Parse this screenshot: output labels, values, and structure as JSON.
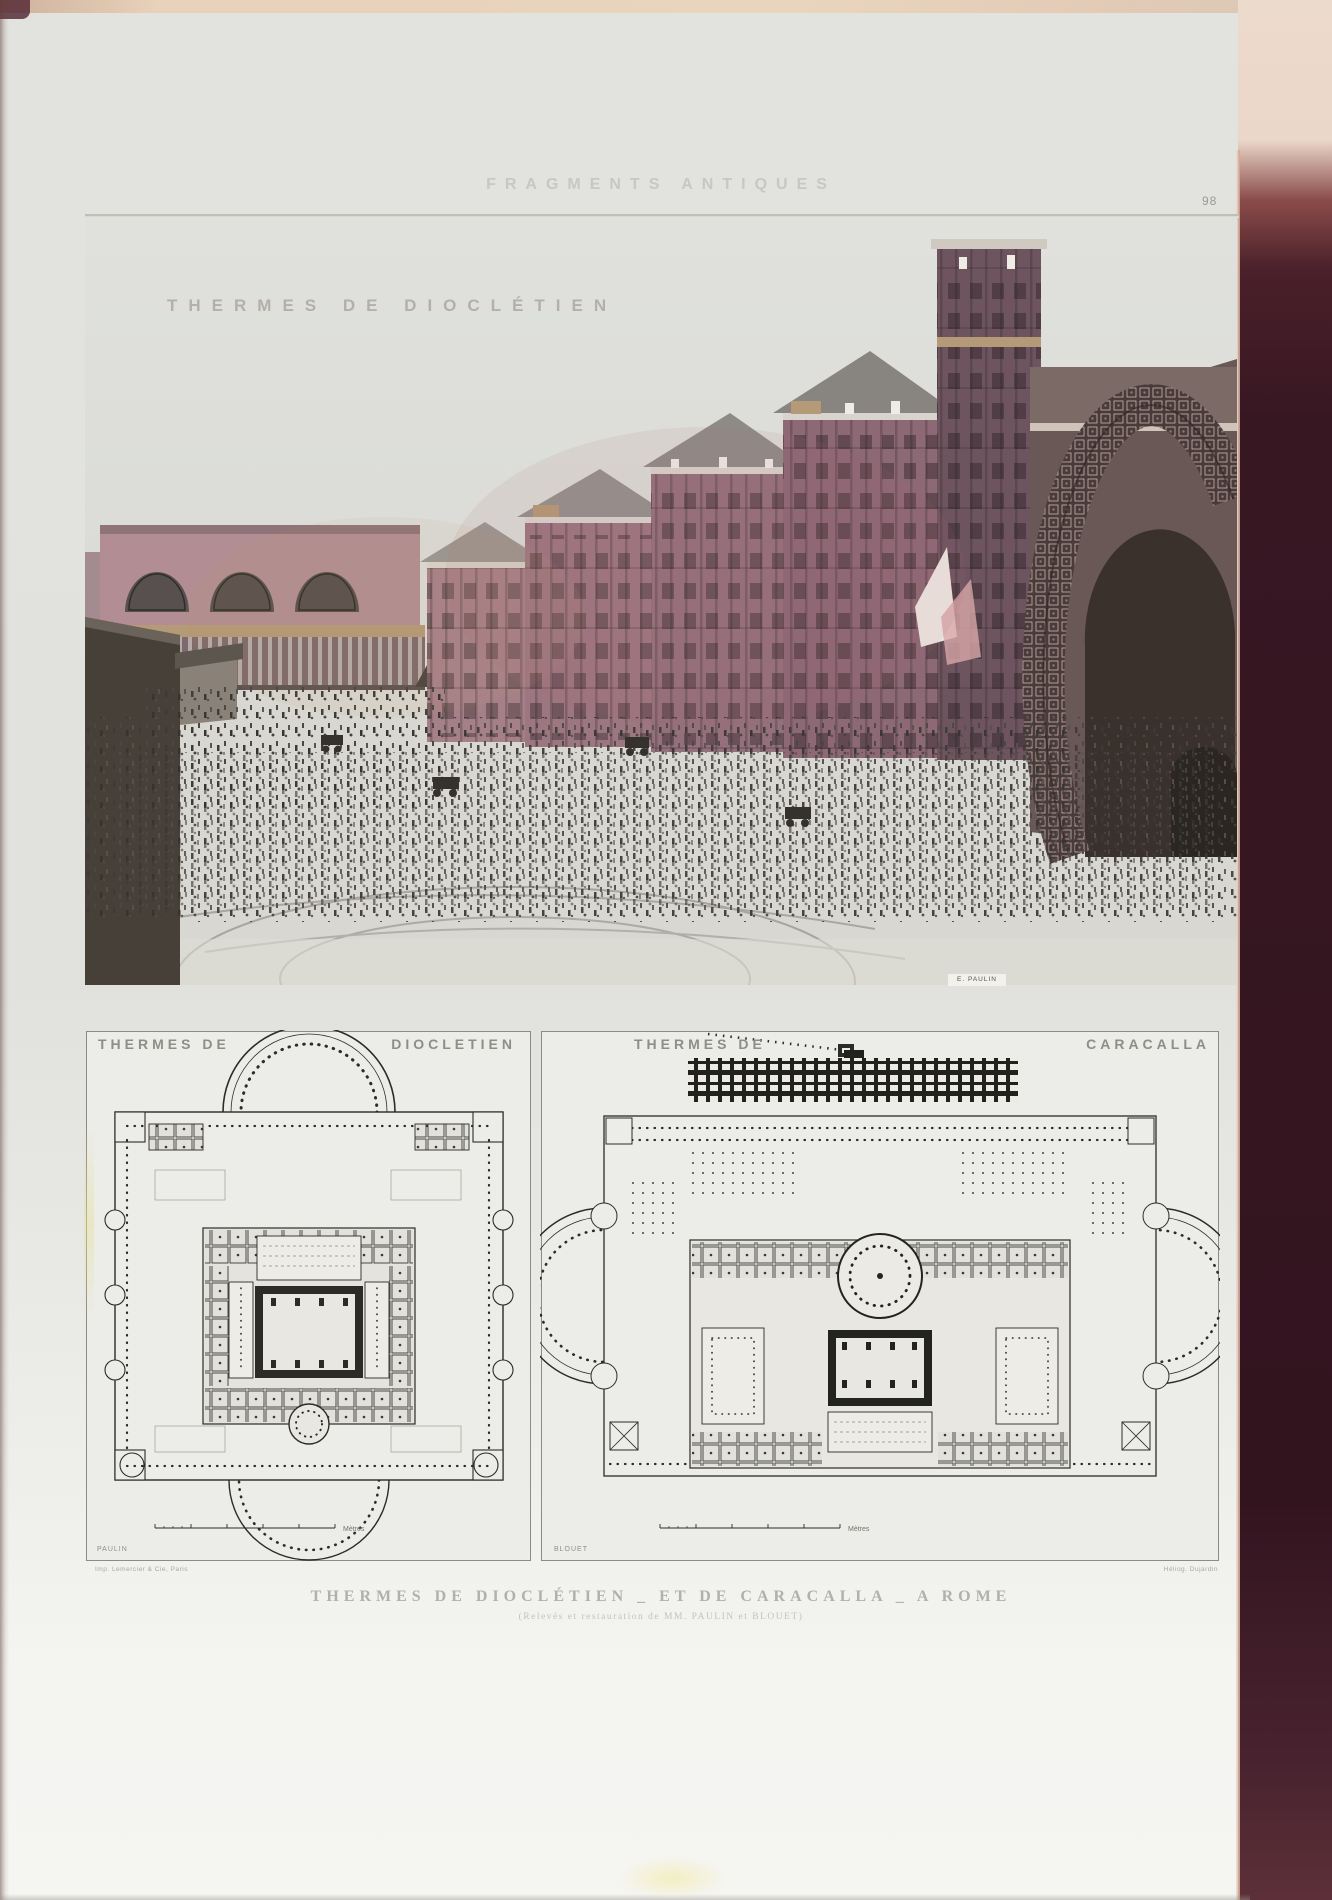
{
  "page": {
    "header": "FRAGMENTS ANTIQUES",
    "page_number": "98",
    "caption_line1": "THERMES DE DIOCLÉTIEN _ ET DE CARACALLA _ A ROME",
    "caption_line2": "(Relevés et restauration de MM. PAULIN et BLOUET)",
    "credit_left": "Imp. Lemercier & Cie, Paris",
    "credit_right": "Héliog. Dujardin"
  },
  "engraving": {
    "title": "THERMES DE DIOCLÉTIEN",
    "signature": "E. PAULIN"
  },
  "plans": {
    "diocletian": {
      "title_left": "THERMES DE",
      "title_right": "DIOCLETIEN",
      "architect": "PAULIN",
      "scale_unit": "Mètres"
    },
    "caracalla": {
      "title_left": "THERMES DE",
      "title_right": "CARACALLA",
      "architect": "BLOUET",
      "scale_unit": "Mètres"
    }
  },
  "colors": {
    "paper": "#e3e4e0",
    "border_maroon": "#3a1822",
    "engraving_rose": "#9c7680",
    "engraving_tan": "#b49a77",
    "plan_ink": "#2c2b28"
  }
}
